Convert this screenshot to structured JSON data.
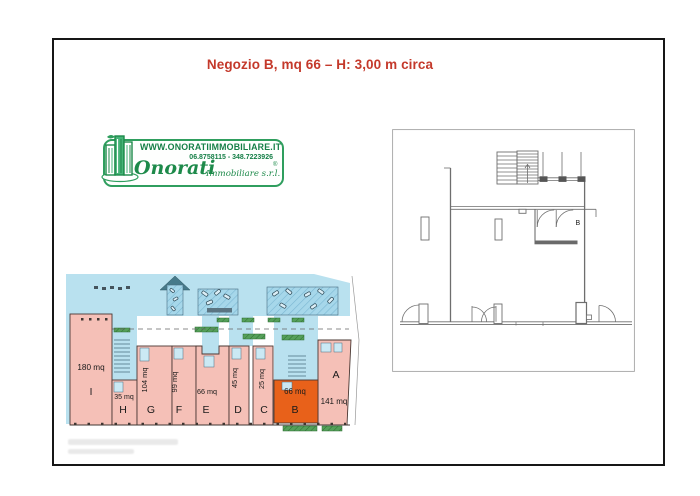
{
  "document": {
    "title": "Negozio B, mq 66 – H: 3,00 m circa"
  },
  "logo": {
    "website": "WWW.ONORATIIMMOBILIARE.IT",
    "phone": "06.8758115 - 348.7223926",
    "brand": "Onorati",
    "brand_suffix": "Immobiliare s.r.l.",
    "registered": "®"
  },
  "site_plan": {
    "units": [
      {
        "id": "I",
        "area": "180 mq"
      },
      {
        "id": "H",
        "area": "35 mq"
      },
      {
        "id": "G",
        "area": "104 mq"
      },
      {
        "id": "F",
        "area": "99 mq"
      },
      {
        "id": "E",
        "area": "66 mq"
      },
      {
        "id": "D",
        "area": "45 mq"
      },
      {
        "id": "C",
        "area": "25 mq"
      },
      {
        "id": "B",
        "area": "66 mq",
        "highlighted": true
      },
      {
        "id": "A",
        "area": "141 mq"
      }
    ],
    "colors": {
      "unit_fill": "#f5c0b7",
      "highlight_fill": "#e8611a",
      "street_fill": "#b9e1ef",
      "parking_fill": "#a6d7ea",
      "planter_green": "#55a05a"
    }
  },
  "floor_plan": {
    "room_label": "B"
  }
}
